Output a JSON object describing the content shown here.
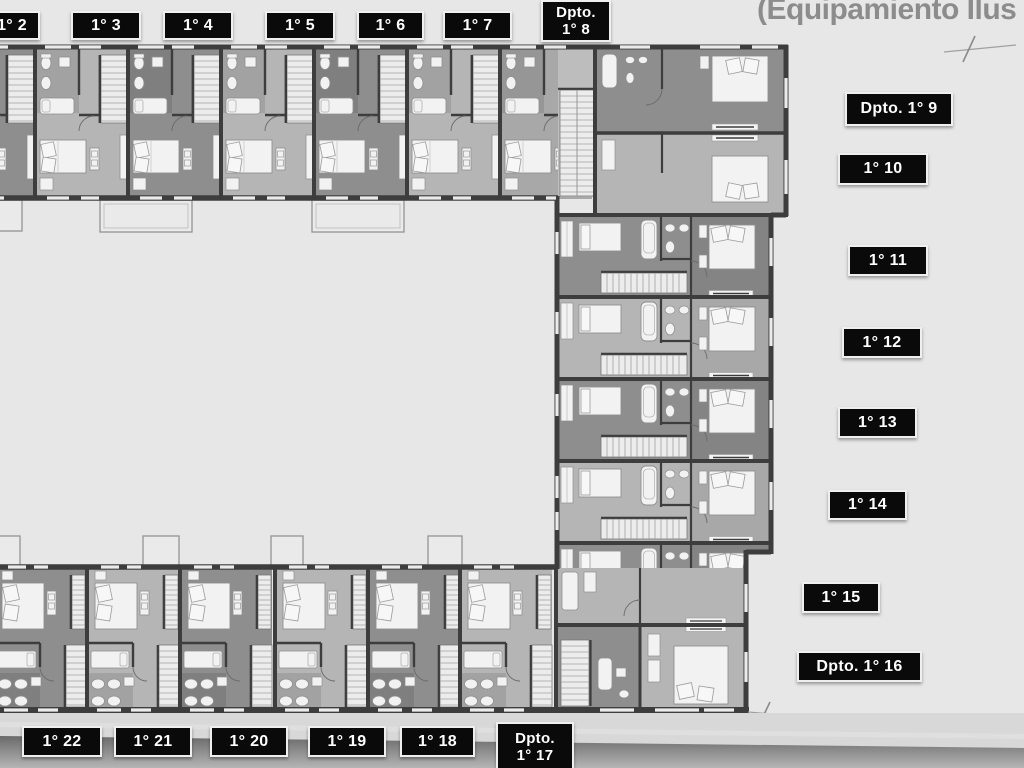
{
  "title": {
    "text": "(Equipamiento Ilus"
  },
  "floor_plan": {
    "colors": {
      "background": "#e7e7e7",
      "wall": "#3d3d3d",
      "unit_light": "#b5b5b5",
      "unit_dark": "#8e8e8e",
      "unit_mid": "#a8a8a8",
      "furniture": "#f2f2f2",
      "stairs": "#ececec",
      "label_bg": "#0a0a0a",
      "label_text": "#ffffff",
      "title_text": "#8c8c8c",
      "street_dark": "#6a6a6a",
      "street_light": "#b5b5b5"
    }
  },
  "labels": {
    "top": [
      {
        "text": "1° 2"
      },
      {
        "text": "1° 3"
      },
      {
        "text": "1° 4"
      },
      {
        "text": "1° 5"
      },
      {
        "text": "1° 6"
      },
      {
        "text": "1° 7"
      },
      {
        "line1": "Dpto.",
        "line2": "1° 8"
      }
    ],
    "right": [
      {
        "text": "Dpto. 1° 9"
      },
      {
        "text": "1° 10"
      },
      {
        "text": "1° 11"
      },
      {
        "text": "1° 12"
      },
      {
        "text": "1° 13"
      },
      {
        "text": "1° 14"
      },
      {
        "text": "1° 15"
      },
      {
        "text": "Dpto. 1° 16"
      }
    ],
    "bottom": [
      {
        "text": "1° 22"
      },
      {
        "text": "1° 21"
      },
      {
        "text": "1° 20"
      },
      {
        "text": "1° 19"
      },
      {
        "text": "1° 18"
      },
      {
        "line1": "Dpto.",
        "line2": "1° 17"
      }
    ]
  }
}
